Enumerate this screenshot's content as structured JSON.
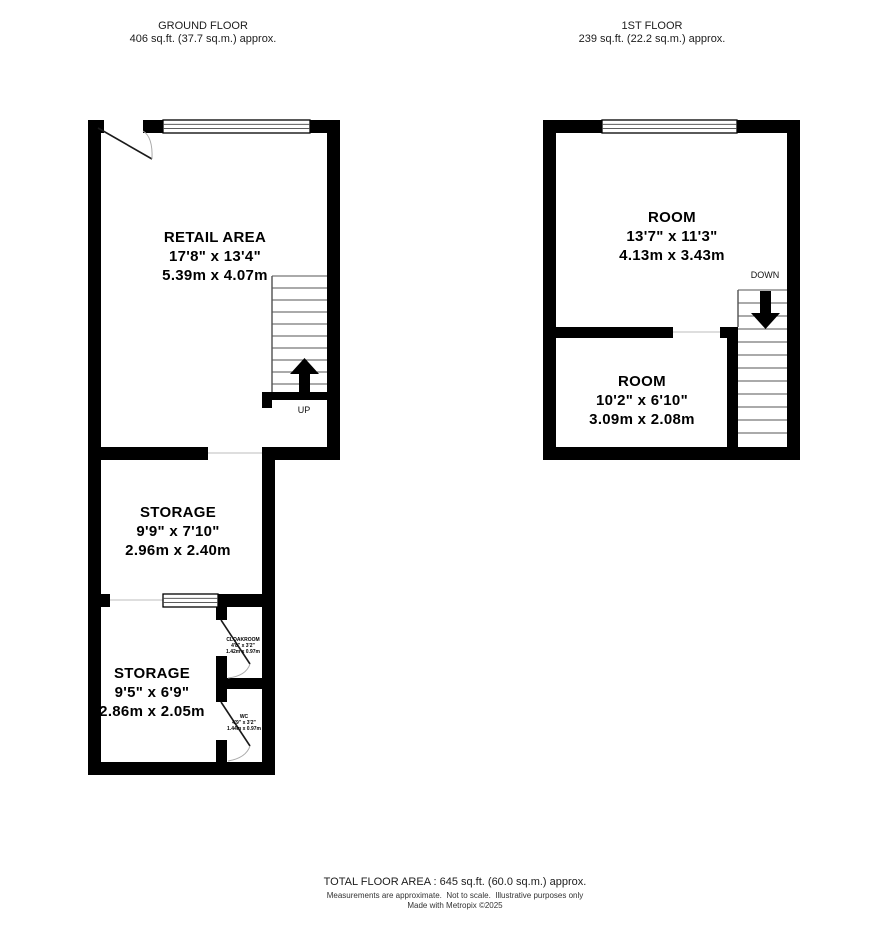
{
  "colors": {
    "wall": "#000000",
    "background": "#ffffff",
    "arc": "#aaaaaa"
  },
  "ground_floor": {
    "header": {
      "title": "GROUND FLOOR",
      "area": "406 sq.ft. (37.7 sq.m.) approx."
    },
    "rooms": [
      {
        "name": "RETAIL AREA",
        "imperial": "17'8\"  x 13'4\"",
        "metric": "5.39m  x 4.07m"
      },
      {
        "name": "STORAGE",
        "imperial": "9'9\"  x 7'10\"",
        "metric": "2.96m  x 2.40m"
      },
      {
        "name": "STORAGE",
        "imperial": "9'5\"  x 6'9\"",
        "metric": "2.86m  x 2.05m"
      },
      {
        "name": "CLOAKROOM",
        "imperial": "4'8\" x 3'2\"",
        "metric": "1.42m x 0.97m"
      },
      {
        "name": "WC",
        "imperial": "4'9\" x 3'2\"",
        "metric": "1.44m x 0.97m"
      }
    ],
    "stairs_label": "UP"
  },
  "first_floor": {
    "header": {
      "title": "1ST FLOOR",
      "area": "239 sq.ft. (22.2 sq.m.) approx."
    },
    "rooms": [
      {
        "name": "ROOM",
        "imperial": "13'7\"  x 11'3\"",
        "metric": "4.13m  x 3.43m"
      },
      {
        "name": "ROOM",
        "imperial": "10'2\"  x 6'10\"",
        "metric": "3.09m  x 2.08m"
      }
    ],
    "stairs_label": "DOWN"
  },
  "footer": {
    "total": "TOTAL FLOOR AREA : 645 sq.ft. (60.0 sq.m.) approx.",
    "disclaimer": "Measurements are approximate.  Not to scale.  Illustrative purposes only",
    "credit": "Made with Metropix ©2025"
  }
}
